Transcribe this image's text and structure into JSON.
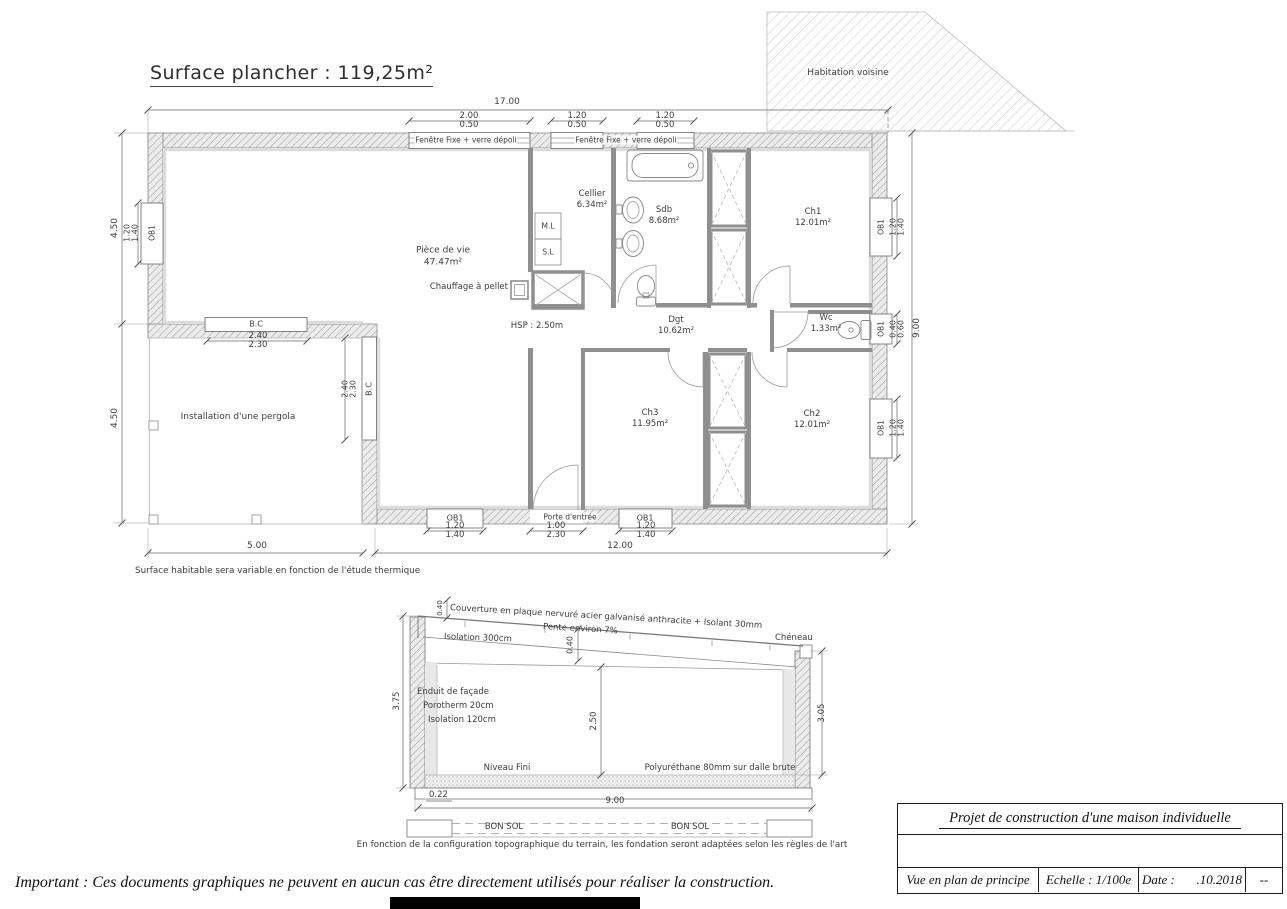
{
  "title": "Surface plancher : 119,25m²",
  "plan": {
    "neighbor": "Habitation voisine",
    "window_top_label1": "Fenêtre Fixe + verre dépoli",
    "window_top_label2": "Fenêtre Fixe + verre dépoli",
    "rooms": {
      "piece_de_vie": {
        "name": "Pièce de vie",
        "area": "47.47m²"
      },
      "cellier": {
        "name": "Cellier",
        "area": "6.34m²"
      },
      "sdb": {
        "name": "Sdb",
        "area": "8.68m²"
      },
      "ch1": {
        "name": "Ch1",
        "area": "12.01m²"
      },
      "dgt": {
        "name": "Dgt",
        "area": "10.62m²"
      },
      "wc": {
        "name": "Wc",
        "area": "1.33m²"
      },
      "ch3": {
        "name": "Ch3",
        "area": "11.95m²"
      },
      "ch2": {
        "name": "Ch2",
        "area": "12.01m²"
      }
    },
    "labels": {
      "ml": "M.L",
      "sl": "S.L",
      "chauffage": "Chauffage à pellet",
      "hsp": "HSP : 2.50m",
      "pergola": "Installation d'une pergola",
      "porte_entree": "Porte d'entrée",
      "ob1": "OB1",
      "bc": "B.C"
    },
    "dims": {
      "top_total": "17.00",
      "w1": "2.00",
      "w1b": "0.50",
      "w2": "1.20",
      "w2b": "0.50",
      "w3": "1.20",
      "w3b": "0.50",
      "left_upper": "4.50",
      "left_lower": "4.50",
      "left_win": "1.20",
      "left_winb": "1.40",
      "right_total": "9.00",
      "right_ch1": "1.20",
      "right_ch1b": "1.40",
      "right_wc": "0.40",
      "right_wcb": "0.60",
      "right_ch2": "1.20",
      "right_ch2b": "1.40",
      "bottom_ob1_l": "1.20",
      "bottom_ob1_lb": "1.40",
      "door": "1.00",
      "doorb": "2.30",
      "bottom_ob1_r": "1.20",
      "bottom_ob1_rb": "1.40",
      "bottom_left": "5.00",
      "bottom_right": "12.00",
      "bc_top": "2.40",
      "bc_topb": "2.30",
      "bc_right": "2.40",
      "bc_rightb": "2.30"
    },
    "note": "Surface habitable sera variable en fonction de l'étude thermique"
  },
  "section": {
    "roof": "Couverture en plaque nervuré acier galvanisé anthracite + Isolant 30mm",
    "pente": "Pente environ 7%",
    "isolation_roof": "Isolation 300cm",
    "cheneau": "Chéneau",
    "wall1": "Enduit de façade",
    "wall2": "Porotherm 20cm",
    "wall3": "Isolation 120cm",
    "niveau": "Niveau Fini",
    "poly": "Polyuréthane 80mm sur dalle brute",
    "bonsol": "BON SOL",
    "dims": {
      "h_left": "3.75",
      "h_right": "3.05",
      "h_int": "2.50",
      "roof_th": "0.40",
      "roof_edge": "0.40",
      "slab": "0.22",
      "width": "9.00"
    },
    "note": "En fonction de la configuration topographique du terrain, les fondation seront adaptées selon les règles de l'art"
  },
  "titleblock": {
    "project": "Projet de construction d'une maison individuelle",
    "view": "Vue en plan de principe",
    "scale": "Echelle : 1/100e",
    "date_label": "Date :",
    "date": ".10.2018",
    "rev": "--"
  },
  "important": "Important : Ces documents graphiques ne peuvent en aucun cas être directement utilisés pour réaliser la construction."
}
